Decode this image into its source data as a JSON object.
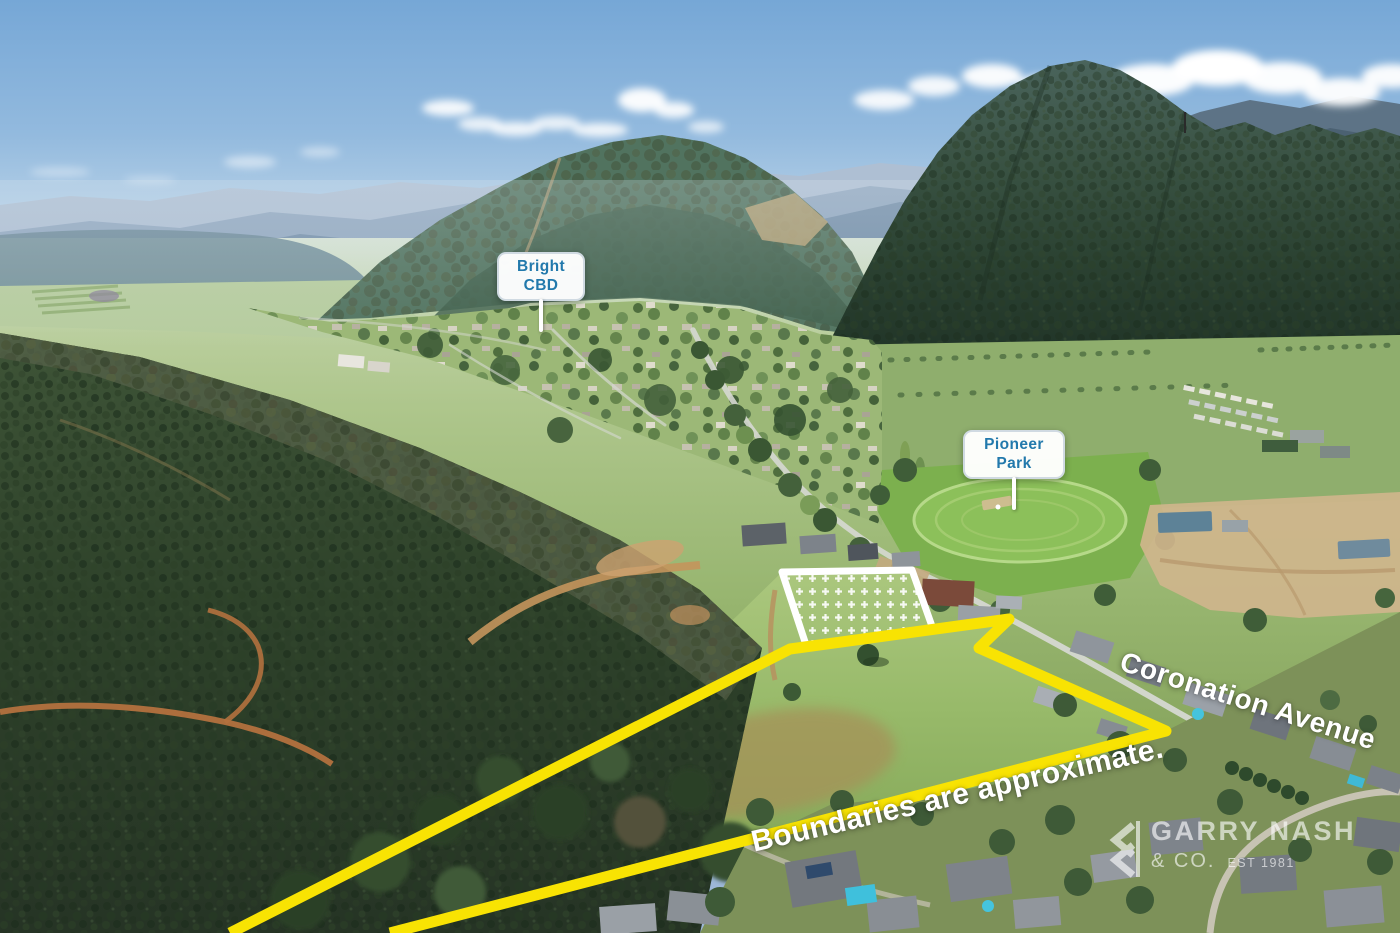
{
  "labels": {
    "bright": {
      "line1": "Bright",
      "line2": "CBD"
    },
    "pioneer": {
      "line1": "Pioneer",
      "line2": "Park"
    }
  },
  "annotations": {
    "street_label": "Coronation Avenue",
    "disclaimer": "Boundaries are approximate."
  },
  "watermark": {
    "brand": "GARRY NASH",
    "suffix": "& CO.",
    "established": "EST 1981"
  },
  "colors": {
    "boundary_yellow": "#F8E303",
    "overlay_white": "#FFFFFF",
    "label_text_blue": "#2279AC"
  }
}
